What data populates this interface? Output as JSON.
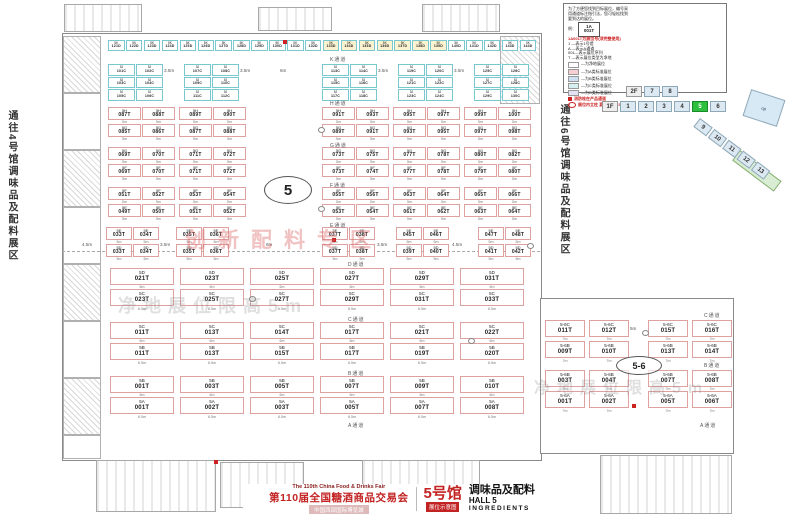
{
  "side_labels": {
    "left": "通往4号馆调味品及配料展区",
    "right": "通往6号馆调味品及配料展区"
  },
  "legend": {
    "intro": [
      "为了方便您找到目标展位，编号采",
      "用通道标注指引法，您可轻松找到",
      "要到达的展位。"
    ],
    "example_label": "例：",
    "example_booth": {
      "line1": "1A",
      "line2": "001T"
    },
    "code_note": "1A001T为展位号(须完整使用)",
    "defs": [
      "1  —表示1号馆",
      "A  —表示A通道",
      "001—表示展位序列",
      "T  —表示展位类型为净地"
    ],
    "types": [
      {
        "label": "—为净地展位",
        "color": "#ffffff"
      },
      {
        "label": "—为A类标准展位",
        "color": "#f6cdd0"
      },
      {
        "label": "—为B类标准展位",
        "color": "#cfdff2"
      },
      {
        "label": "—为C类标准展位",
        "color": "#d6f0f0"
      },
      {
        "label": "—为D类标准展位",
        "color": "#e4e2f2"
      }
    ],
    "fire_note": "消防栓在产品通道",
    "pillar_note": "展位内立柱 直径均为1.5m"
  },
  "navigator": {
    "floor2": "2F",
    "floor2_halls": [
      "7",
      "8"
    ],
    "floor1": "1F",
    "floor1_halls": [
      "1",
      "2",
      "3",
      "4",
      "5",
      "6"
    ],
    "active_hall": "5",
    "diagonal_halls": [
      "9",
      "10",
      "11",
      "12",
      "13"
    ],
    "up_label": "up"
  },
  "markers": {
    "hall_circle": "5",
    "annex_circle": "5-6",
    "annex_width": "5m"
  },
  "aisles": {
    "upper": [
      "K通道",
      "H通道",
      "G通道",
      "F通道",
      "E通道"
    ],
    "lower": [
      "D通道",
      "C通道",
      "B通道",
      "A通道"
    ],
    "annex": [
      "C通道",
      "B通道",
      "A通道"
    ]
  },
  "dims": {
    "k_row": [
      "3.5m",
      "3.5m",
      "6m",
      "3.5m",
      "3.5m"
    ],
    "mid_row": [
      "4.5m",
      "3.5m",
      "6m",
      "3.5m",
      "4.5m"
    ],
    "upper_booth": "5m",
    "lower_top": "6m",
    "lower_bottom": "6.5m",
    "annex_booth": "7m"
  },
  "watermarks": {
    "zone": "创新配料专区",
    "net1": "净地展位限高5m",
    "net2": "净地展位限高5m"
  },
  "zones": {
    "top_row": [
      "5K 121D",
      "5K 122D",
      "5K 123D",
      "5K 124D",
      "5K 125D",
      "5K 126D",
      "5K 127D",
      "5K 128D",
      "5K 129D",
      "5K 130D",
      "5K 131D",
      "5K 132D",
      "5K 133D",
      "5K 134D",
      "5K 135D",
      "5K 136D",
      "5K 137D",
      "5K 138D",
      "5K 139D",
      "5K 140D",
      "5K 141D",
      "5K 142D",
      "5K 143D",
      "5K 144D"
    ],
    "k_groups": [
      [
        "5J 101C",
        "5J 102C",
        "5J 103C",
        "5J 104C",
        "5J 105C",
        "5J 106C"
      ],
      [
        "5J 107C",
        "5J 108C",
        "5J 109C",
        "5J 110C",
        "5J 111C",
        "5J 112C"
      ],
      [
        "5J 113C",
        "5J 114C",
        "5J 115C",
        "5J 116C",
        "5J 117C",
        "5J 118C"
      ],
      [
        "5J 119C",
        "5J 120C",
        "5J 121C",
        "5J 122C",
        "5J 123C",
        "5J 124C"
      ],
      [
        "5J 125C",
        "5J 126C",
        "5J 127C",
        "5J 128C",
        "5J 129C",
        "5J 130C"
      ]
    ],
    "upper_bands": [
      {
        "top": [
          "5H 087T",
          "5H 088T",
          "5H 089T",
          "5H 090T",
          "5H 091T",
          "5H 093T",
          "5H 095T",
          "5H 097T",
          "5H 099T",
          "5H 100T"
        ],
        "bottom": [
          "5G 085T",
          "5G 086T",
          "5G 087T",
          "5G 088T",
          "5G 089T",
          "5G 091T",
          "5G 093T",
          "5G 095T",
          "5G 097T",
          "5G 098T"
        ]
      },
      {
        "top": [
          "5G 069T",
          "5G 070T",
          "5G 071T",
          "5G 072T",
          "5G 073T",
          "5G 075T",
          "5G 077T",
          "5G 078T",
          "5G 080T",
          "5G 082T"
        ],
        "bottom": [
          "5F 069T",
          "5F 070T",
          "5F 071T",
          "5F 072T",
          "5F 073T",
          "5F 074T",
          "5F 077T",
          "5F 078T",
          "5F 079T",
          "5F 080T"
        ]
      },
      {
        "top": [
          "5F 051T",
          "5F 052T",
          "5F 053T",
          "5F 054T",
          "5F 055T",
          "5F 056T",
          "5F 063T",
          "5F 064T",
          "5F 065T",
          "5F 066T"
        ],
        "bottom": [
          "5E 049T",
          "5E 050T",
          "5E 051T",
          "5E 052T",
          "5E 053T",
          "5E 054T",
          "5E 061T",
          "5E 062T",
          "5E 063T",
          "5E 064T"
        ]
      },
      {
        "top": [
          "5E 033T",
          "5E 034T",
          "5E 035T",
          "5E 036T",
          "5E 037T",
          "5E 038T",
          "5E 045T",
          "5E 046T",
          "5E 047T",
          "5E 048T"
        ],
        "bottom": [
          "5D 033T",
          "5D 034T",
          "5D 035T",
          "5D 036T",
          "5D 037T",
          "5D 038T",
          "5D 039T",
          "5D 040T",
          "5D 041T",
          "5D 042T"
        ]
      }
    ],
    "lower_bands": [
      {
        "top": [
          "5D 021T",
          "5D 023T",
          "5D 025T",
          "5D 027T",
          "5D 029T",
          "5D 031T"
        ],
        "bottom": [
          "5C 023T",
          "5C 025T",
          "5C 027T",
          "5C 029T",
          "5C 031T",
          "5C 033T"
        ]
      },
      {
        "top": [
          "5C 011T",
          "5C 013T",
          "5C 014T",
          "5C 017T",
          "5C 021T",
          "5C 022T"
        ],
        "bottom": [
          "5B 011T",
          "5B 013T",
          "5B 015T",
          "5B 017T",
          "5B 019T",
          "5B 020T"
        ]
      },
      {
        "top": [
          "5B 001T",
          "5B 003T",
          "5B 005T",
          "5B 007T",
          "5B 009T",
          "5B 010T"
        ],
        "bottom": [
          "5A 001T",
          "5A 002T",
          "5A 003T",
          "5A 005T",
          "5A 007T",
          "5A 008T"
        ]
      }
    ],
    "annex_bands": [
      {
        "top": [
          "5-6C 011T",
          "5-6C 012T",
          "5-6C 015T",
          "5-6C 016T"
        ],
        "bottom": [
          "5-6B 009T",
          "5-6B 010T",
          "5-6B 013T",
          "5-6B 014T"
        ]
      },
      {
        "top": [
          "5-6B 003T",
          "5-6B 004T",
          "5-6B 007T",
          "5-6B 008T"
        ],
        "bottom": [
          "5-6A 001T",
          "5-6A 002T",
          "5-6A 005T",
          "5-6A 006T"
        ]
      }
    ]
  },
  "title_block": {
    "fair_en": "The 110th China Food & Drinks Fair",
    "fair_cn": "第110届全国糖酒商品交易会",
    "venue": "中国西部国际博览城",
    "hall_cn": "5号馆",
    "map_label": "展位示意图",
    "category_cn": "调味品及配料",
    "hall_en": "HALL 5",
    "category_en": "INGREDIENTS"
  }
}
